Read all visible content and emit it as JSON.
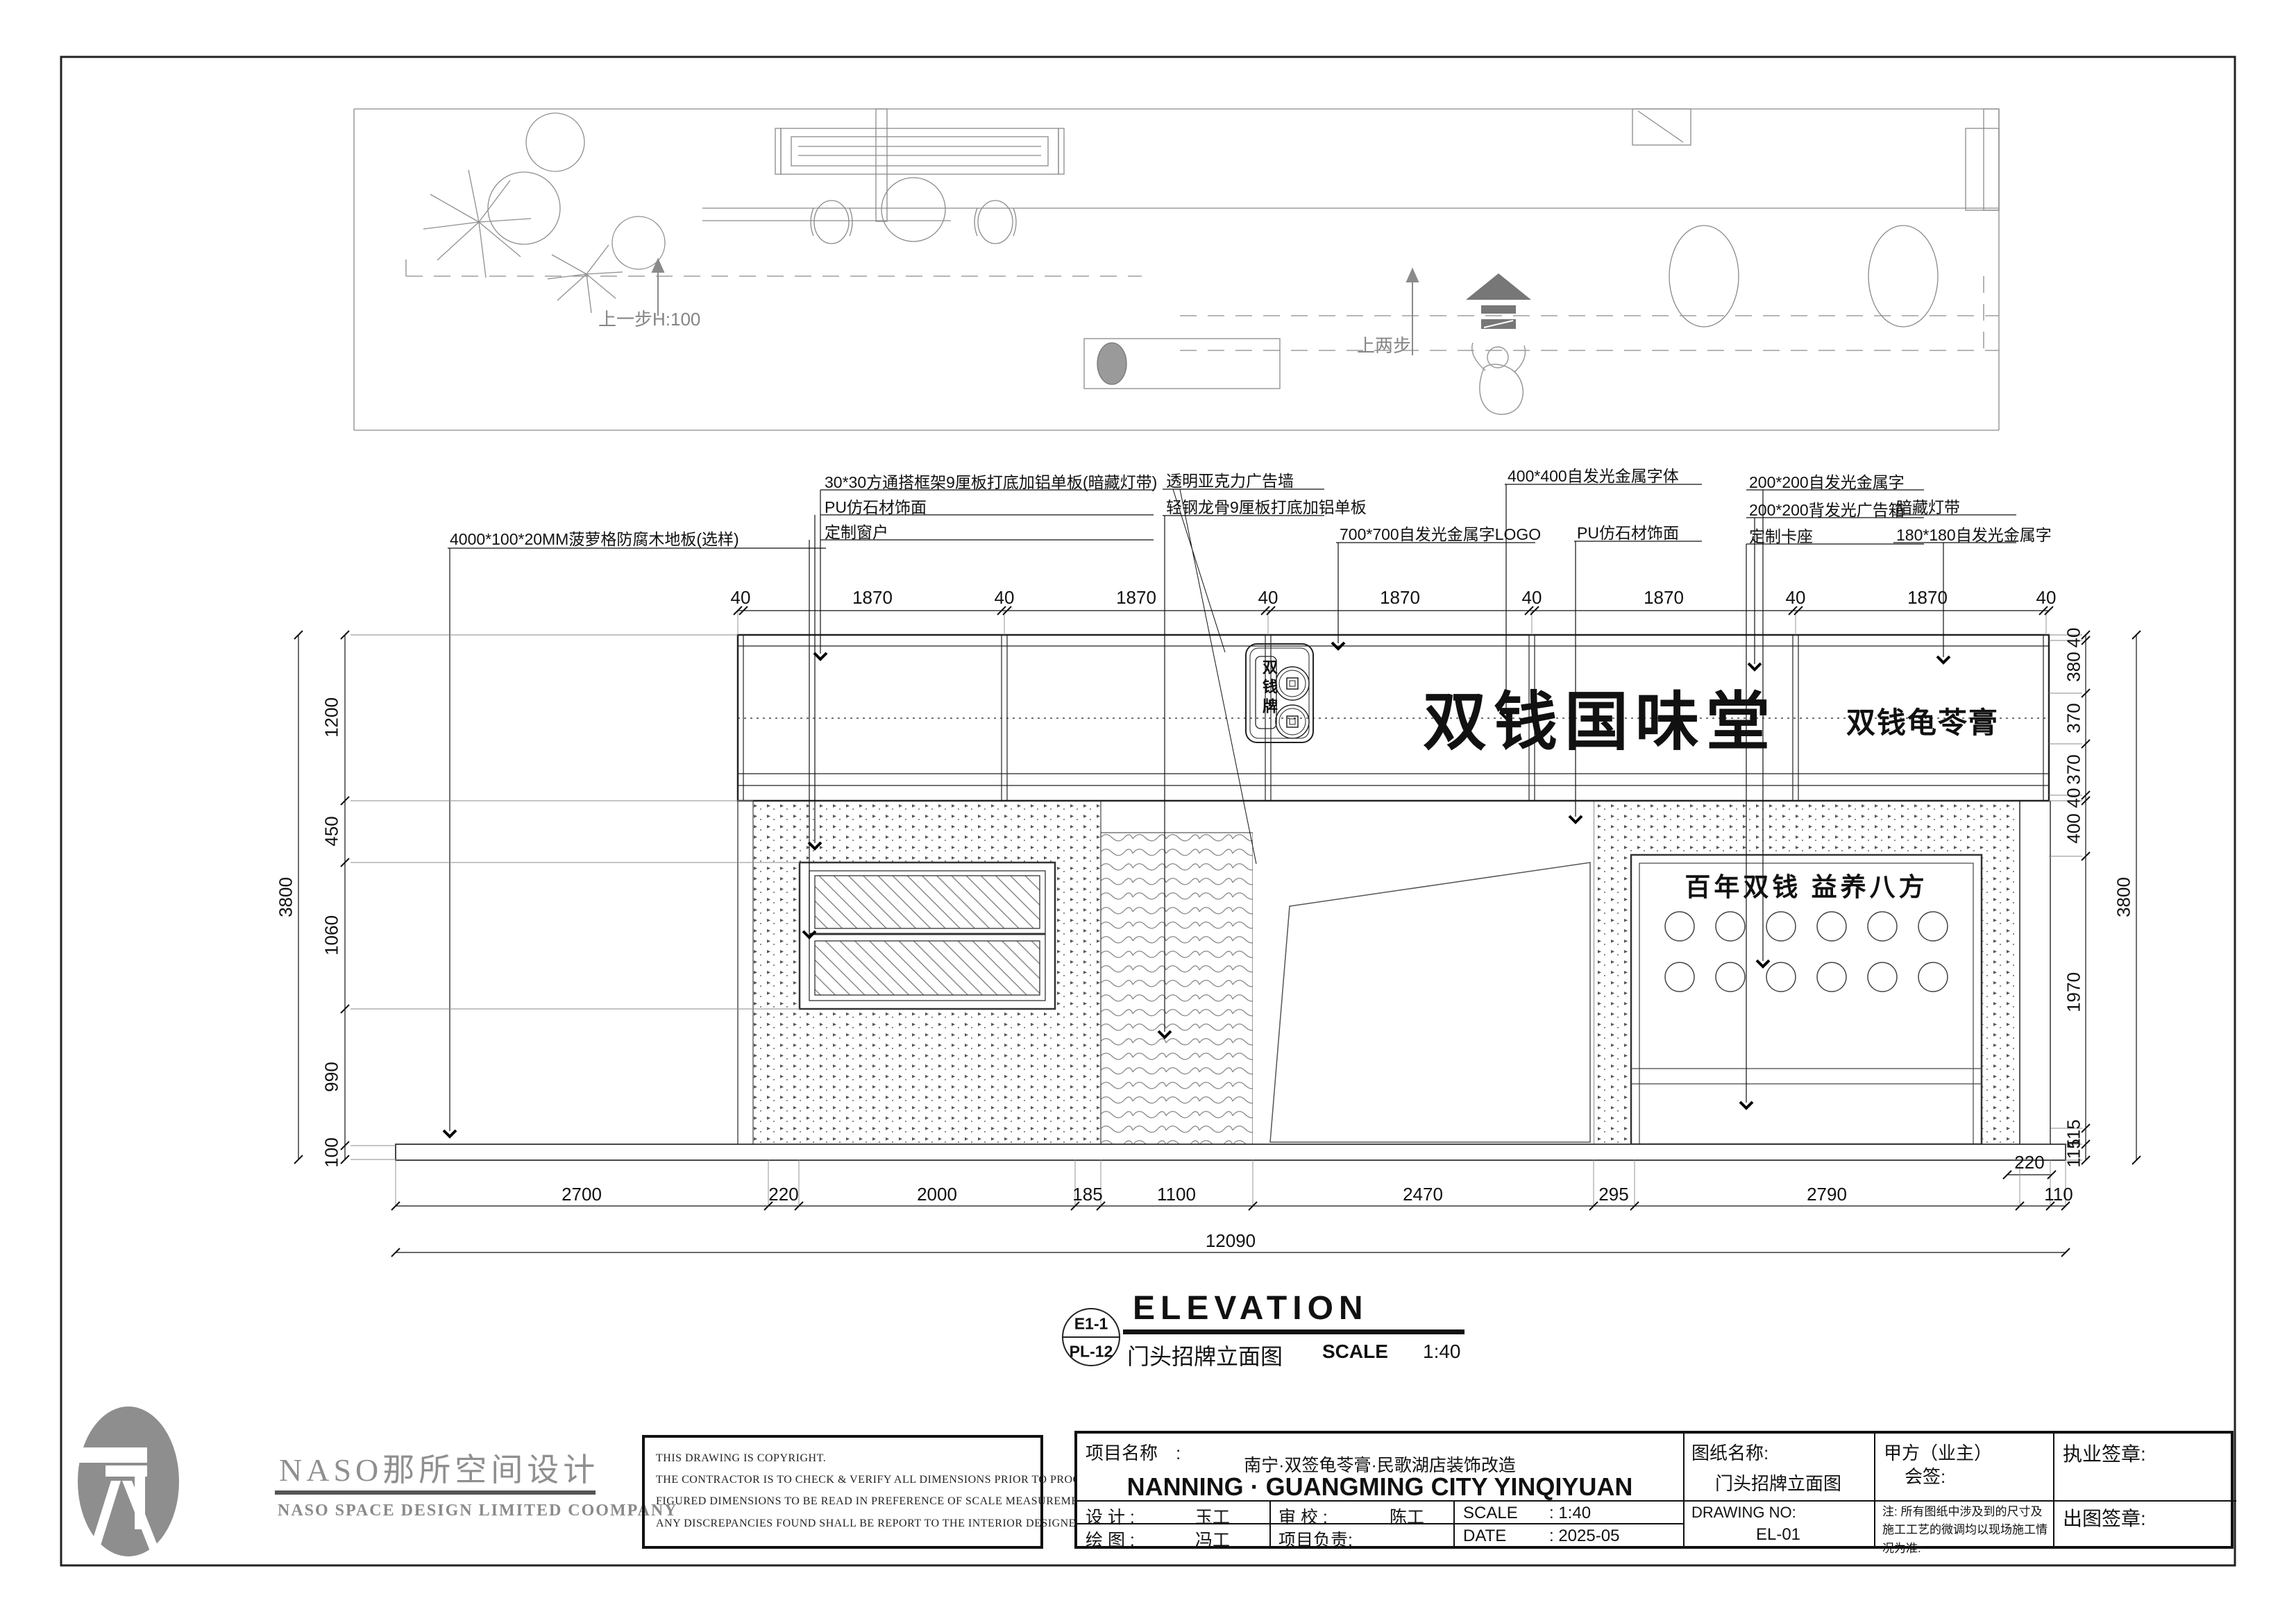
{
  "plan": {
    "step1": "上一步H:100",
    "step2": "上两步"
  },
  "elevation": {
    "sign_main": "双钱国味堂",
    "sign_right": "双钱龟苓膏",
    "logo_vertical": "双钱牌",
    "box_title": "百年双钱  益养八方",
    "annotations": {
      "floor": "4000*100*20MM菠萝格防腐木地板(选样)",
      "b1": "30*30方通搭框架9厘板打底加铝单板(暗藏灯带)",
      "b2": "PU仿石材饰面",
      "b3": "定制窗户",
      "c1": "透明亚克力广告墙",
      "c2": "轻钢龙骨9厘板打底加铝单板",
      "d1": "700*700自发光金属字LOGO",
      "e1": "400*400自发光金属字体",
      "f1": "PU仿石材饰面",
      "g1": "200*200自发光金属字",
      "g2": "200*200背发光广告箱",
      "g3": "定制卡座",
      "h1": "暗藏灯带",
      "h2": "180*180自发光金属字"
    },
    "dims": {
      "top": [
        "40",
        "1870",
        "40",
        "1870",
        "40",
        "1870",
        "40",
        "1870",
        "40",
        "1870",
        "40"
      ],
      "left": [
        "1200",
        "450",
        "1060",
        "990",
        "100"
      ],
      "left_total": "3800",
      "right": [
        "40",
        "380",
        "370",
        "370",
        "40",
        "400",
        "1970",
        "115",
        "115"
      ],
      "right_total": "3800",
      "bottom": [
        "2700",
        "220",
        "2000",
        "185",
        "1100",
        "2470",
        "295",
        "2790",
        "220",
        "110"
      ],
      "bottom_total": "12090"
    },
    "title": "ELEVATION",
    "title_ref_top": "E1-1",
    "title_ref_bottom": "PL-12",
    "title_cn": "门头招牌立面图",
    "scale_label": "SCALE",
    "scale_value": "1:40"
  },
  "footer": {
    "naso_cn": "NASO那所空间设计",
    "naso_en": "NASO  SPACE  DESIGN  LIMITED  COOMPANY",
    "copyright": [
      "THIS DRAWING IS COPYRIGHT.",
      "THE CONTRACTOR IS TO CHECK & VERIFY ALL DIMENSIONS PRIOR TO PROCEEDING WORK.",
      "FIGURED DIMENSIONS TO BE READ IN PREFERENCE OF SCALE MEASUREMENT.",
      "ANY DISCREPANCIES FOUND SHALL BE REPORT TO THE INTERIOR DESIGNER."
    ],
    "titleblock": {
      "project_label": "项目名称　:",
      "project_cn": "南宁·双签龟苓膏·民歌湖店装饰改造",
      "project_en": "NANNING · GUANGMING CITY YINQIYUAN",
      "design_label": "设  计  :",
      "design_value": "玉工",
      "check_label": "审  校  :",
      "check_value": "陈工",
      "scale_label": "SCALE",
      "scale_value": ":    1:40",
      "draw_label": "绘  图  :",
      "draw_value": "冯工",
      "pm_label": "项目负责:",
      "date_label": "DATE",
      "date_value": ":    2025-05",
      "sheetname_label": "图纸名称:",
      "sheetname_value": "门头招牌立面图",
      "drawingno_label": "DRAWING NO:",
      "drawingno_value": "EL-01",
      "client_label": "甲方（业主）",
      "client_sign": "会签:",
      "note": "注: 所有图纸中涉及到的尺寸及施工工艺的微调均以现场施工情况为准.",
      "sig1": "执业签章:",
      "sig2": "出图签章:"
    }
  }
}
